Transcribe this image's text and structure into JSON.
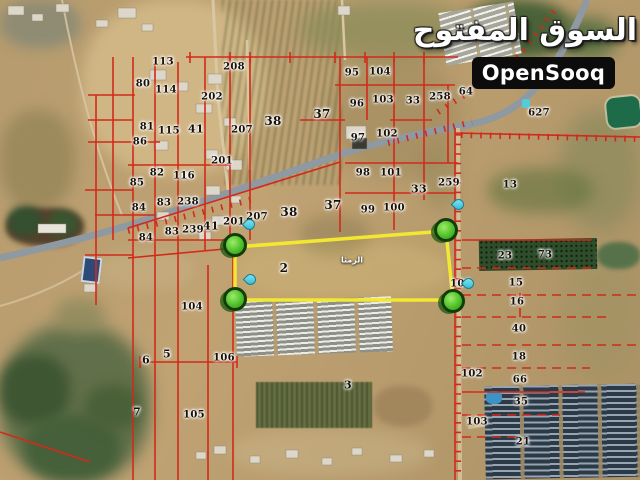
{
  "watermark": {
    "arabic_logo": "السوق المفتوح",
    "latin_logo": "OpenSooq",
    "logo_bg": "#0c0c0c",
    "logo_text_color": "#ffffff"
  },
  "map": {
    "type": "satellite-cadastral",
    "place_label": "الرمثا",
    "place_label_pos": [
      352,
      260
    ],
    "colors": {
      "cadastral_line": "#d22a1a",
      "highlight_outline": "#f2e832",
      "corner_marker": "#4fc02a",
      "pin": "#2ab5cf",
      "highway": "#8e99a1",
      "terrain_base": "#b59b6e"
    },
    "highlight_polygon": {
      "points": [
        [
          235,
          247
        ],
        [
          446,
          231
        ],
        [
          453,
          300
        ],
        [
          235,
          300
        ]
      ],
      "markers": [
        [
          235,
          245
        ],
        [
          446,
          230
        ],
        [
          235,
          299
        ],
        [
          453,
          301
        ]
      ],
      "pins": [
        [
          247,
          231
        ],
        [
          456,
          211
        ],
        [
          248,
          286
        ],
        [
          466,
          290
        ]
      ]
    },
    "parcel_labels": [
      [
        "113",
        163,
        62
      ],
      [
        "208",
        234,
        67
      ],
      [
        "80",
        143,
        84
      ],
      [
        "114",
        166,
        90
      ],
      [
        "202",
        212,
        97
      ],
      [
        "95",
        352,
        73
      ],
      [
        "104",
        380,
        72
      ],
      [
        "96",
        357,
        104
      ],
      [
        "103",
        383,
        100
      ],
      [
        "33",
        413,
        101
      ],
      [
        "258",
        440,
        97
      ],
      [
        "64",
        466,
        92
      ],
      [
        "37",
        322,
        114,
        12
      ],
      [
        "38",
        273,
        121,
        12
      ],
      [
        "207",
        242,
        130
      ],
      [
        "81",
        147,
        127
      ],
      [
        "115",
        169,
        131
      ],
      [
        "41",
        196,
        129,
        11
      ],
      [
        "86",
        140,
        142
      ],
      [
        "97",
        358,
        138
      ],
      [
        "102",
        387,
        134
      ],
      [
        "201",
        222,
        161
      ],
      [
        "82",
        157,
        173
      ],
      [
        "116",
        184,
        176
      ],
      [
        "85",
        137,
        183
      ],
      [
        "98",
        363,
        173
      ],
      [
        "101",
        391,
        173
      ],
      [
        "259",
        449,
        183
      ],
      [
        "33",
        419,
        189,
        11
      ],
      [
        "13",
        510,
        185
      ],
      [
        "627",
        539,
        113
      ],
      [
        "84",
        139,
        208
      ],
      [
        "83",
        164,
        203
      ],
      [
        "238",
        188,
        202
      ],
      [
        "37",
        333,
        205,
        12
      ],
      [
        "38",
        289,
        212,
        12
      ],
      [
        "99",
        368,
        210
      ],
      [
        "100",
        394,
        208
      ],
      [
        "207",
        257,
        217
      ],
      [
        "201",
        234,
        222
      ],
      [
        "41",
        211,
        226,
        11
      ],
      [
        "239",
        193,
        230
      ],
      [
        "83",
        172,
        232
      ],
      [
        "84",
        146,
        238
      ],
      [
        "2",
        284,
        268,
        12
      ],
      [
        "23",
        505,
        256
      ],
      [
        "73",
        545,
        255
      ],
      [
        "101",
        461,
        284
      ],
      [
        "15",
        516,
        283
      ],
      [
        "16",
        517,
        302
      ],
      [
        "104",
        192,
        307
      ],
      [
        "40",
        519,
        329
      ],
      [
        "5",
        167,
        354,
        11
      ],
      [
        "6",
        146,
        360,
        11
      ],
      [
        "106",
        224,
        358
      ],
      [
        "18",
        519,
        357
      ],
      [
        "102",
        472,
        374
      ],
      [
        "66",
        520,
        380
      ],
      [
        "3",
        348,
        385,
        11
      ],
      [
        "35",
        521,
        402
      ],
      [
        "7",
        137,
        412,
        11
      ],
      [
        "105",
        194,
        415
      ],
      [
        "103",
        477,
        422
      ],
      [
        "21",
        523,
        442
      ]
    ]
  }
}
